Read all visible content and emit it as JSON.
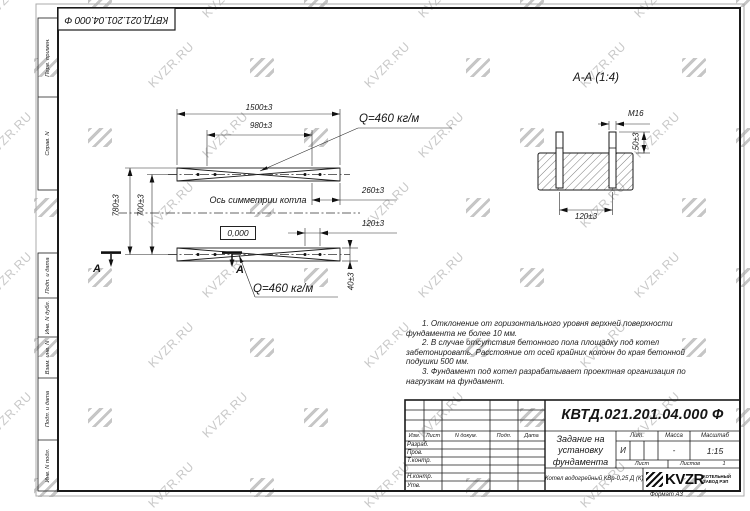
{
  "watermark": {
    "text": "KVZR.RU"
  },
  "doc": {
    "number_top": "КВТД.021.201.04.000 Ф",
    "format_note": "Формат А3"
  },
  "margin_labels": {
    "items": [
      "Перв. примен.",
      "Справ. N",
      "Подп. и дата",
      "Инв. N дубл.",
      "Взам. инв. N",
      "Подп. и дата",
      "Инв. N подл."
    ]
  },
  "main_view": {
    "dim_1500": "1500±3",
    "dim_980": "980±3",
    "dim_260": "260±3",
    "dim_120": "120±3",
    "dim_40": "40±3",
    "dim_780": "780±3",
    "dim_700": "700±3",
    "load_top": "Q=460 кг/м",
    "load_bottom": "Q=460 кг/м",
    "axis_label": "Ось симметрии котла",
    "elevation": "0,000",
    "section_letter_left": "А",
    "section_letter_right": "А"
  },
  "section_view": {
    "title": "А-А (1:4)",
    "thread_label": "М16",
    "dim_50": "50±3",
    "dim_120": "120±3"
  },
  "notes": {
    "line1": "1. Отклонение от горизонтального уровня верхней поверхности",
    "line2": "фундамента не более 10 мм.",
    "line3": "2. В случае отсутствия бетонного пола площадку под котел",
    "line4": "забетонировать. Расстояние от осей крайних колонн до края бетонной",
    "line5": "подушки 500 мм.",
    "line6": "3. Фундамент под котел разрабатывает проектная организация по",
    "line7": "нагрузкам на фундамент."
  },
  "title_block": {
    "number": "КВТД.021.201.04.000 Ф",
    "title_line1": "Задание на",
    "title_line2": "установку",
    "title_line3": "фундамента",
    "product": "Котел водогрейный КВр-0,25 Д (К)",
    "col_izm": "Изм.",
    "col_list": "Лист",
    "col_ndoc": "N докум.",
    "col_podp": "Подп.",
    "col_data": "Дата",
    "row_razrab": "Разраб.",
    "row_prov": "Пров.",
    "row_tkontr": "Т.контр.",
    "row_nkontr": "Н.контр.",
    "row_utv": "Утв.",
    "lit_header": "Лит.",
    "lit_value": "И",
    "massa_header": "Масса",
    "massa_value": "-",
    "scale_header": "Масштаб",
    "scale_value": "1:15",
    "list_label": "Лист",
    "listov_label": "Листов",
    "listov_value": "1",
    "logo_text": "KVZR",
    "logo_sub1": "КОТЕЛЬНЫЙ",
    "logo_sub2": "ЗАВОД РЭП"
  }
}
